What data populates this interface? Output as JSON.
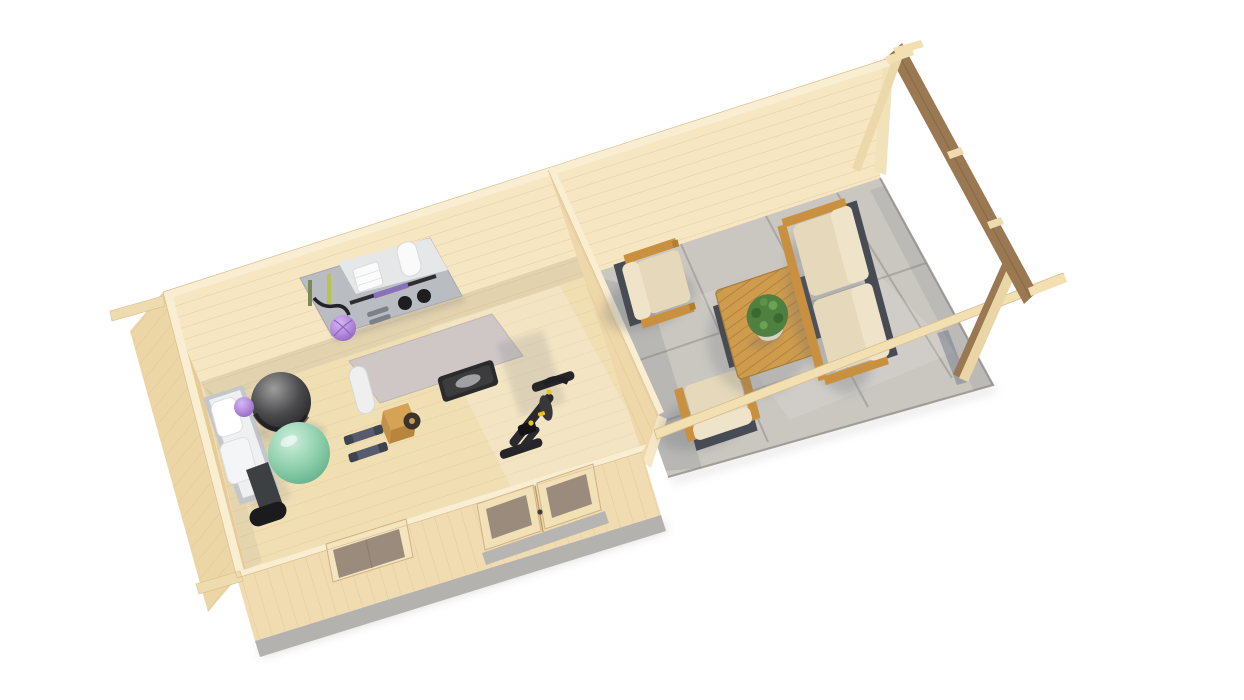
{
  "canvas": {
    "width": 1244,
    "height": 700,
    "background": "#ffffff"
  },
  "scene": {
    "kind": "3d-product-render",
    "subject": "log-cabin-with-home-gym-and-covered-terrace",
    "view": "elevated-corner-view-roof-removed",
    "rooms": [
      {
        "name": "home-gym-room"
      },
      {
        "name": "covered-terrace"
      }
    ],
    "gym_objects": [
      "wall-storage-rack",
      "folded-towels",
      "rolled-towel",
      "barbell",
      "kettlebells",
      "hanging-resistance-bands",
      "black-straps",
      "purple-massage-ball",
      "white-folded-treadmill",
      "dark-exercise-ball",
      "mint-yoga-ball",
      "small-purple-ball",
      "exercise-mat",
      "rolled-yoga-mat",
      "step-platform",
      "wooden-plyo-box",
      "weight-plate",
      "dumbbell-pair",
      "black-exercise-bike"
    ],
    "terrace_objects": [
      "lounge-armchair",
      "lounge-armchair",
      "two-seat-sofa",
      "slatted-coffee-table",
      "potted-plant",
      "concrete-patio-slabs"
    ],
    "structure_objects": [
      "log-back-wall",
      "left-gable-wall",
      "partition-wall",
      "front-wall",
      "window",
      "double-glazed-door",
      "foundation-strip",
      "gable-roof-frame",
      "barge-board",
      "front-eave-beam",
      "corner-brace",
      "ridge-tip",
      "protruding-beam-tips"
    ]
  },
  "palette": {
    "bg": "#ffffff",
    "wall_pine": "#f6e6c2",
    "wall_pine_shaded": "#e7cb97",
    "divider_face": "#eed7a8",
    "gable_exterior": "#ecd6a6",
    "front_wall": "#f0dcb0",
    "wall_top": "#f9eed2",
    "floor_wood": "#f1dfb4",
    "plank_line": "#dcc08c",
    "foundation": "#b4b2ae",
    "concrete": "#cac7c1",
    "beam_pine": "#f2dfb2",
    "gable_board": "#9a7852",
    "furniture_wood": "#c9913f",
    "table_wood": "#cf9b4d",
    "cushion": "#e6d9bb",
    "cushion_light": "#efe3c9",
    "furniture_metal": "#474b53",
    "plant_green": "#4f8040",
    "pot_gray": "#d7d3c9",
    "ball_green": "#8fd0ac",
    "ball_dark": "#3a3a3c",
    "ball_purple": "#b48ade",
    "mat_gray": "#cfc6c6",
    "mat_roll": "#efefef",
    "treadmill_white": "#eef0f2",
    "equipment_dark": "#26262a",
    "accent_yellow": "#e8c31a",
    "rack_panel": "#b9bcc0",
    "glass_brown": "#9b8b7d",
    "shadow": "#5f6671"
  }
}
